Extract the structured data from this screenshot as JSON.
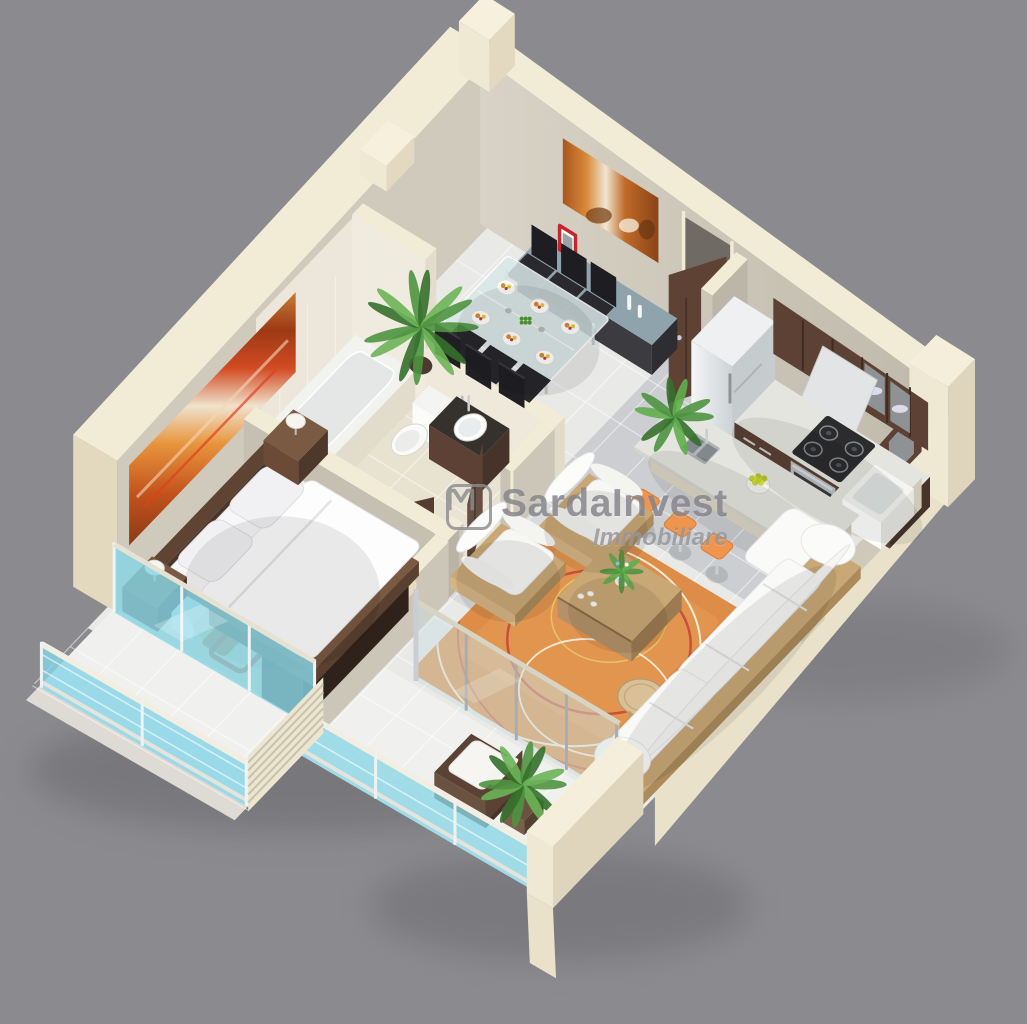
{
  "watermark": {
    "brand": "SardaInvest",
    "tagline": "Immobiliare",
    "logo_icon": "m-monogram-icon"
  },
  "colors": {
    "background": "#8b8b8f",
    "wall_cream": "#f2ecd7",
    "wall_cream_dark": "#e2d9bf",
    "wall_inner": "#cdc7ba",
    "wall_inner_dark": "#bcb6a8",
    "tile_light": "#e9e9e8",
    "tile_grout": "#ffffff",
    "kitchen_floor": "#b4b8bd",
    "bedroom_floor": "#eae4d3",
    "bathroom_floor": "#e8e2d1",
    "balcony_floor": "#f0f1ef",
    "glass_cyan": "#85d4e6",
    "glass_pale": "#ccdfe0",
    "chrome": "#a7adb2",
    "wood_dark": "#5c4134",
    "wood_darker": "#46332a",
    "wood_light": "#c9a876",
    "marble": "#e5e5e0",
    "stainless": "#bfc3c6",
    "seat_black": "#26262a",
    "white_furniture": "#fafafa",
    "accent_orange": "#f0954e",
    "rug_orange": "#e2964f",
    "rug_red": "#c8503a",
    "rug_cream": "#f2ead8",
    "bedroom_rug": "#e9dbbc",
    "plant_green": "#4e9440",
    "plant_green_dark": "#35702c",
    "lemon": "#cdd838",
    "red_frame": "#c1272d",
    "granite": "#35322e",
    "watermark_gray": "#86868a"
  },
  "scene": {
    "description": "3D isometric cutaway floor plan of a one-bedroom apartment, viewed from above on a gray background",
    "rooms": [
      {
        "name": "bedroom",
        "items": [
          "double-bed",
          "pillows",
          "duvet",
          "headboard",
          "nightstands",
          "table-lamps",
          "wardrobe",
          "abstract-painting",
          "patterned-rug"
        ]
      },
      {
        "name": "bathroom",
        "items": [
          "bathtub",
          "toilet",
          "vanity-sink",
          "tiled-walls"
        ]
      },
      {
        "name": "dining-area",
        "items": [
          "glass-dining-table",
          "black-chairs",
          "place-settings",
          "salad-bowl",
          "sideboard",
          "red-photo-frame",
          "candles",
          "wall-art",
          "potted-palm"
        ]
      },
      {
        "name": "kitchen",
        "items": [
          "refrigerator",
          "gas-range",
          "range-hood",
          "upper-cabinets",
          "marble-counter",
          "farm-sink",
          "island-double-sink",
          "fruit-bowl",
          "bar-stools",
          "island-plant"
        ]
      },
      {
        "name": "living-room",
        "items": [
          "sofa",
          "armchairs",
          "coffee-table",
          "flower-vase",
          "orange-rug",
          "rattan-side-table"
        ]
      },
      {
        "name": "entrance",
        "items": [
          "entry-door"
        ]
      },
      {
        "name": "bedroom-balcony",
        "items": [
          "sliding-window",
          "glass-balustrade",
          "louver-screen"
        ]
      },
      {
        "name": "living-balcony",
        "items": [
          "sliding-glass-doors",
          "rattan-armchair",
          "potted-plant",
          "glass-balustrade",
          "parapet-wall"
        ]
      }
    ]
  }
}
